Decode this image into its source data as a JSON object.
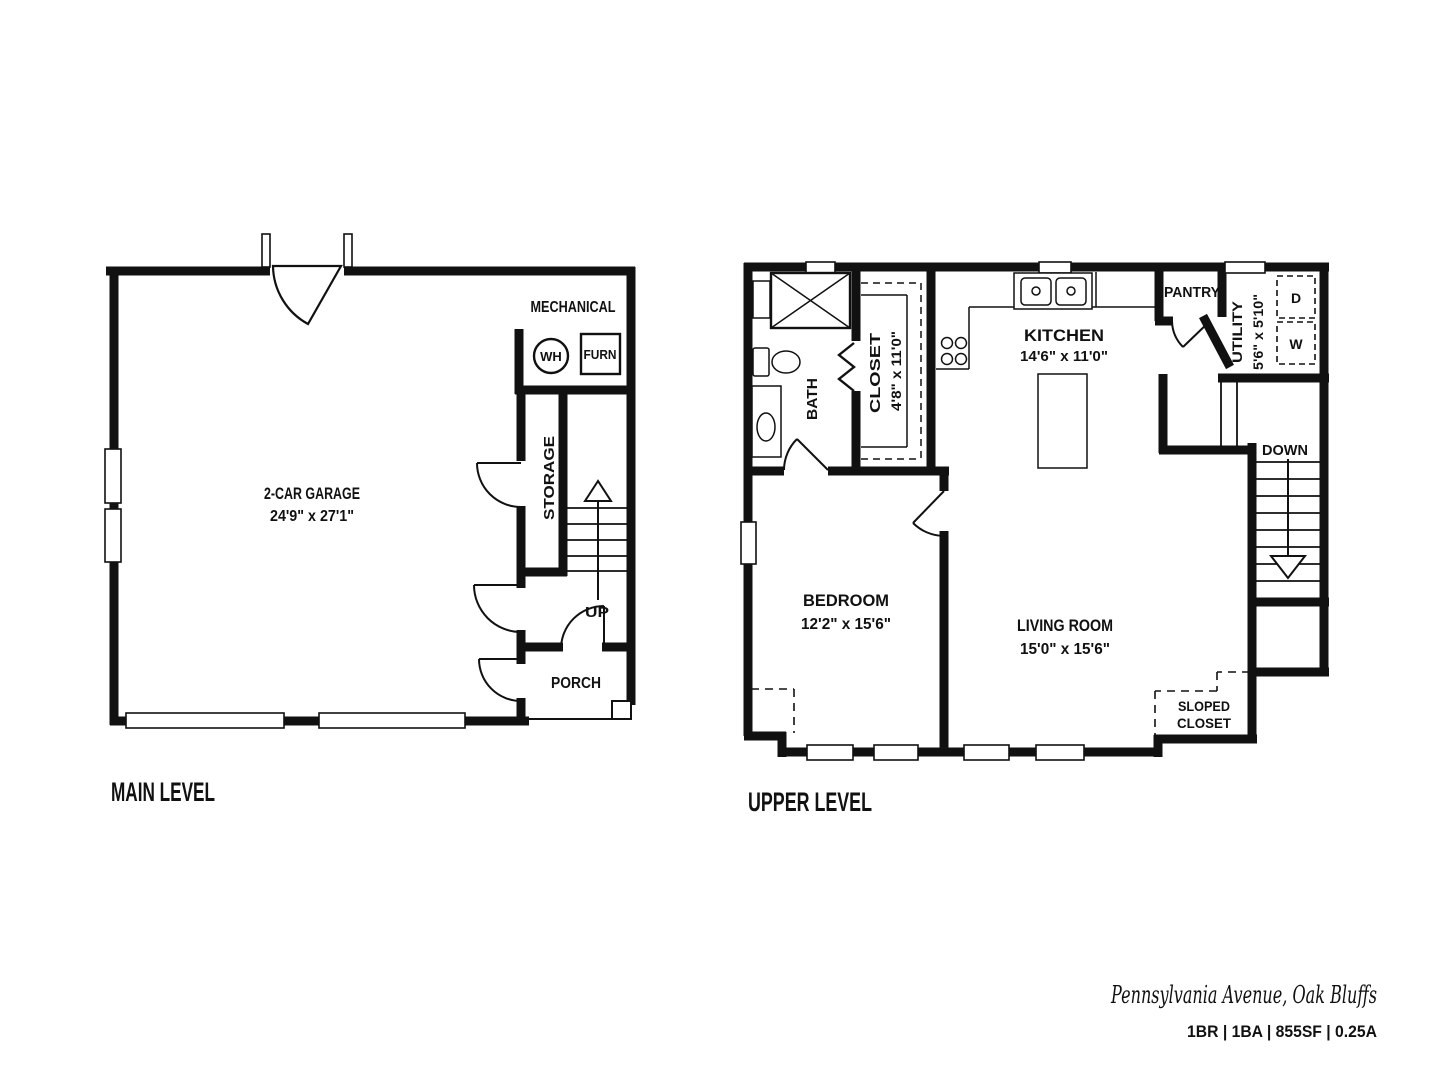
{
  "main_level": {
    "title": "MAIN LEVEL",
    "garage": {
      "name": "2-CAR GARAGE",
      "dims": "24'9\" x 27'1\""
    },
    "mechanical": {
      "name": "MECHANICAL",
      "water_heater": "WH",
      "furnace": "FURN"
    },
    "storage": "STORAGE",
    "stairs_up": "UP",
    "porch": "PORCH"
  },
  "upper_level": {
    "title": "UPPER LEVEL",
    "bath": "BATH",
    "closet": {
      "name": "CLOSET",
      "dims": "4'8\" x 11'0\""
    },
    "kitchen": {
      "name": "KITCHEN",
      "dims": "14'6\" x 11'0\""
    },
    "pantry": "PANTRY",
    "utility": {
      "name": "UTILITY",
      "dims": "5'6\" x 5'10\""
    },
    "dryer": "D",
    "washer": "W",
    "stairs_down": "DOWN",
    "bedroom": {
      "name": "BEDROOM",
      "dims": "12'2\" x 15'6\""
    },
    "living_room": {
      "name": "LIVING ROOM",
      "dims": "15'0\" x 15'6\""
    },
    "sloped_closet": {
      "line1": "SLOPED",
      "line2": "CLOSET"
    }
  },
  "footer": {
    "address": "Pennsylvania Avenue, Oak Bluffs",
    "specs": "1BR | 1BA | 855SF | 0.25A"
  },
  "colors": {
    "ink": "#111111",
    "background": "#ffffff"
  }
}
